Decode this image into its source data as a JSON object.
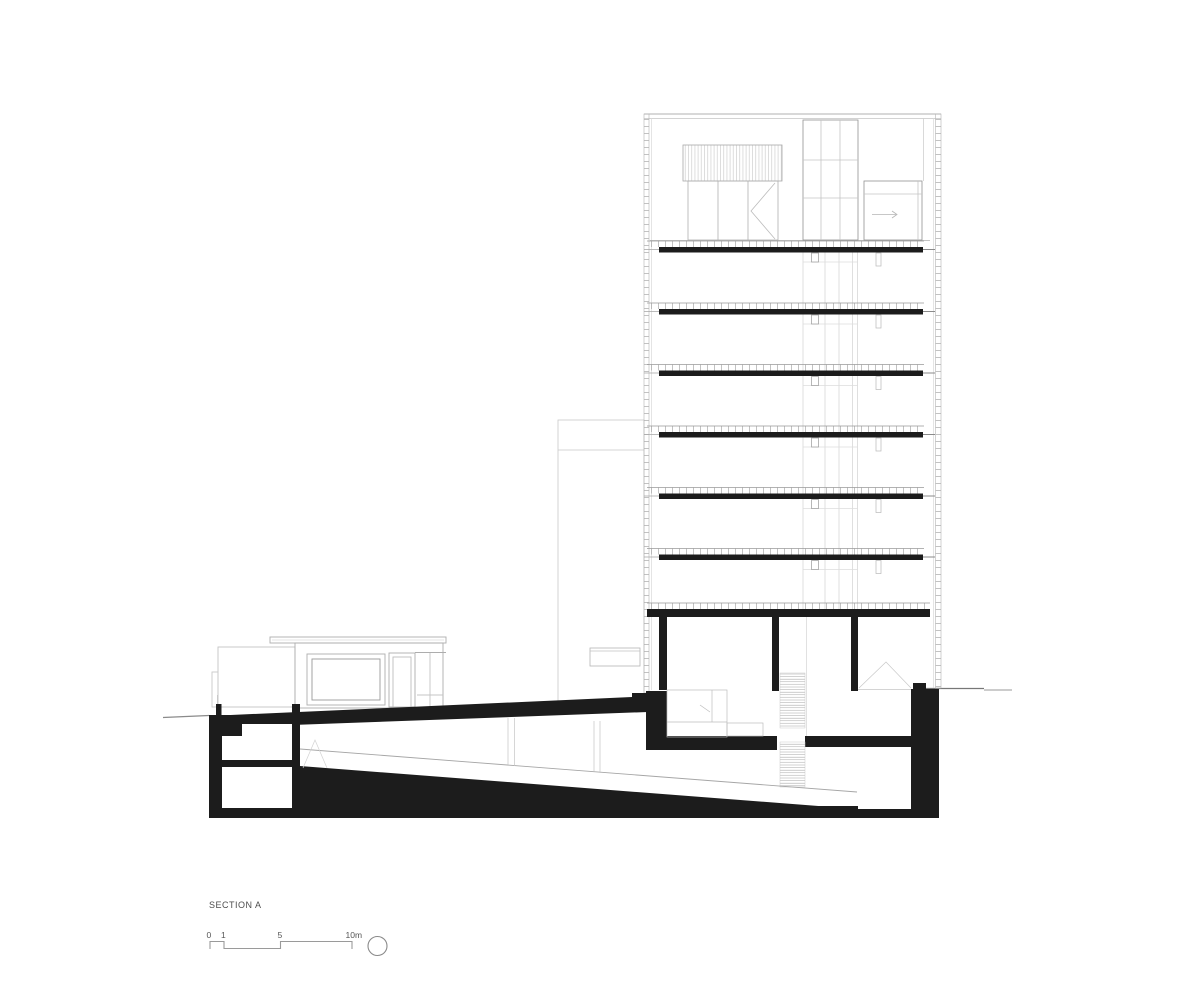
{
  "drawing": {
    "kind": "architectural-section",
    "title": "SECTION A",
    "scale_bar": {
      "tick_labels": [
        "0",
        "1",
        "5",
        "10m"
      ],
      "unit": "m"
    },
    "symbols": {
      "north_symbol": "empty-circle"
    },
    "colors": {
      "ink": "#1c1c1c",
      "line_light": "#c4c4c4",
      "line_mid": "#999999",
      "text": "#4d4d4d",
      "background": "#ffffff"
    }
  }
}
